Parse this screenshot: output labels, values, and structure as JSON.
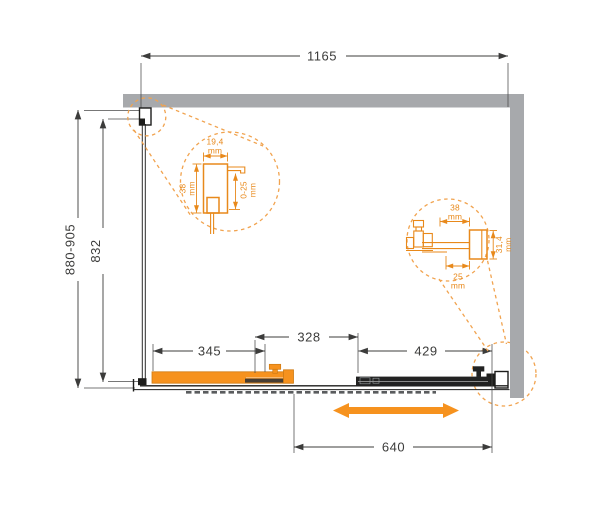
{
  "drawing": {
    "overall": {
      "width": "1165",
      "height_range": "880-905",
      "glass_height": "832"
    },
    "bottom": {
      "door_panel": "345",
      "overlap": "328",
      "fixed_panel": "429",
      "opening": "640"
    },
    "detail_wall_profile": {
      "width": "19,4",
      "width_unit": "mm",
      "depth": "38",
      "depth_unit": "mm",
      "adjustment": "0-25",
      "adjustment_unit": "mm"
    },
    "detail_bottom_rail": {
      "width": "38",
      "width_unit": "mm",
      "inner_width": "25",
      "inner_width_unit": "mm",
      "height": "31,4",
      "height_unit": "mm"
    },
    "icons": {
      "slide_direction": "double-headed-horizontal-arrow"
    },
    "colors": {
      "accent_orange": "#F6921E",
      "detail_orange": "#E8891B",
      "wall_gray": "#A7A9AC",
      "line_dark": "#3C3C3B"
    }
  }
}
